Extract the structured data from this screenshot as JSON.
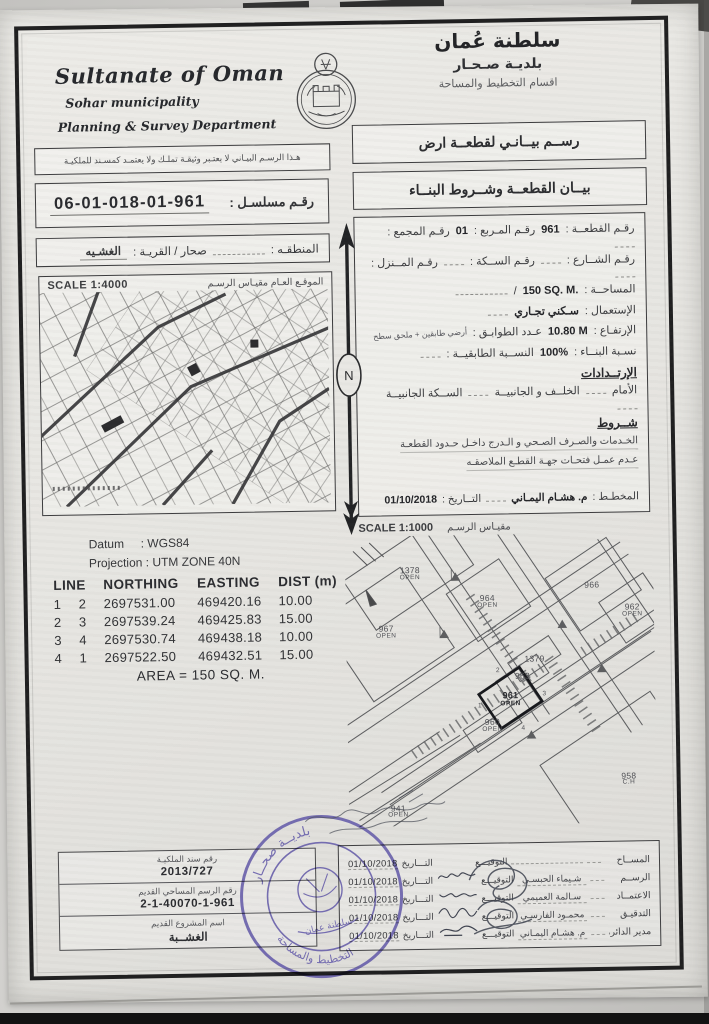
{
  "header": {
    "title_en": "Sultanate of Oman",
    "municipality_en": "Sohar municipality",
    "department_en": "Planning & Survey Department",
    "title_ar": "سلطنة عُمان",
    "municipality_ar": "بلديـة صـحـار",
    "department_ar": "اقسام التخطيط والمساحة"
  },
  "titles": {
    "drawing_ar": "رســم بيــانـي لقطعــة ارض",
    "statement_ar": "بيــان القطعــة وشــروط البنــاء"
  },
  "notices": {
    "disclaimer_ar": "هـذا الرسـم البيـاني لا يعتـبر وثيقـة تملـك ولا يعتمـد كمسـند للملكيـة"
  },
  "serial": {
    "label_ar": "رقـم مسلسـل :",
    "value": "06-01-018-01-961"
  },
  "region": {
    "label_ar": "المنطقـه :",
    "mid_label_ar": "صحار / القريـة :",
    "village_ar": "الغشـيه"
  },
  "plot_info": {
    "plot_no_label": "رقـم القطعــة :",
    "plot_no": "961",
    "square_label": "رقـم المـربع :",
    "square_no": "01",
    "complex_label": "رقـم المجمع :",
    "street_label": "رقـم الشــارع :",
    "lane_label": "رقـم الســكة :",
    "house_label": "رقـم المــنزل :",
    "area_label": "المساحــة :",
    "area_value": "150 SQ. M.",
    "use_label": "الإستعمال :",
    "use_value": "سـكني تجـاري",
    "height_label": "الإرتفـاع :",
    "height_value": "10.80 M",
    "floors_label": "عـدد الطوابـق :",
    "floors_value": "أرضي طابقين + ملحق سطح",
    "build_ratio_label": "نسـبة البنــاء :",
    "build_ratio_value": "100%",
    "floor_ratio_label": "النســبة الطابقيــة :",
    "setbacks_heading": "الإرتــدادات",
    "front_label": "الأمام",
    "back_side_label": "الخلــف و الجانبيــة",
    "side_lane_label": "الســكة الجانبيــة",
    "conditions_heading": "شــروط",
    "condition_1": "الخـدمات والصـرف الصـحي و الـدرج داخـل حـدود القطعـة",
    "condition_2": "عـدم عمـل فتحـات جهـة القطـع الملاصقـه",
    "planner_label": "المخطـط :",
    "planner_name": "م. هشـام اليمـاني",
    "planner_date_label": "التــاريخ :",
    "planner_date": "01/10/2018"
  },
  "overview_map": {
    "scale": "SCALE 1:4000",
    "caption_ar": "الموقـع العـام    مقيـاس الرسـم"
  },
  "north_arrow": {
    "label": "N"
  },
  "geodesy": {
    "datum_label": "Datum",
    "datum_value": ": WGS84",
    "projection_label": "Projection",
    "projection_value": ": UTM ZONE 40N"
  },
  "coords": {
    "headers": [
      "LINE",
      "NORTHING",
      "EASTING",
      "DIST (m)"
    ],
    "rows": [
      [
        "1",
        "2",
        "2697531.00",
        "469420.16",
        "10.00"
      ],
      [
        "2",
        "3",
        "2697539.24",
        "469425.83",
        "15.00"
      ],
      [
        "3",
        "4",
        "2697530.74",
        "469438.18",
        "10.00"
      ],
      [
        "4",
        "1",
        "2697522.50",
        "469432.51",
        "15.00"
      ]
    ],
    "area_note": "AREA = 150 SQ. M."
  },
  "detail_map": {
    "scale": "SCALE 1:1000",
    "caption_ar": "مقيـاس الرسـم",
    "plots": [
      {
        "label": "1378",
        "sub": "OPEN"
      },
      {
        "label": "964",
        "sub": "OPEN"
      },
      {
        "label": "966",
        "sub": ""
      },
      {
        "label": "962",
        "sub": "OPEN"
      },
      {
        "label": "967",
        "sub": "OPEN"
      },
      {
        "label": "1379",
        "sub": ""
      },
      {
        "label": "963",
        "sub": ""
      },
      {
        "label": "961",
        "sub": "OPEN"
      },
      {
        "label": "960",
        "sub": "OPEN"
      },
      {
        "label": "958",
        "sub": "C.H"
      },
      {
        "label": "941",
        "sub": "OPEN"
      }
    ],
    "vertices": [
      "1",
      "2",
      "3",
      "4"
    ]
  },
  "old_refs": {
    "deed_label_ar": "رقم سند الملكيـة",
    "deed_value": "2013/727",
    "old_drawing_label_ar": "رقم الرسم المساحي القديم",
    "old_drawing_value": "2-1-40070-1-961",
    "old_project_label_ar": "اسم المشروع القديم",
    "old_project_value_ar": "الغشــبة"
  },
  "signatures": {
    "sign_label_ar": "التوقيـــع",
    "date_label_ar": "التـــاريخ",
    "rows": [
      {
        "role_ar": "المســاح",
        "name_ar": "",
        "date": "01/10/2018"
      },
      {
        "role_ar": "الرســم",
        "name_ar": "شـيماء الحبسـي",
        "date": "01/10/2018"
      },
      {
        "role_ar": "الاعتمــاد",
        "name_ar": "سـالمة العميمي",
        "date": "01/10/2018"
      },
      {
        "role_ar": "التدقيـق",
        "name_ar": "محمـود الفارسـي",
        "date": "01/10/2018"
      },
      {
        "role_ar": "مدير الدائرة",
        "name_ar": "م. هشـام اليمـاني",
        "date": "01/10/2018"
      }
    ]
  },
  "stamp": {
    "arc_top_ar": "بلديــة صحــار",
    "arc_bottom_ar": "التخطيط والمساحة",
    "center_ar": "سلطنة عمان"
  }
}
